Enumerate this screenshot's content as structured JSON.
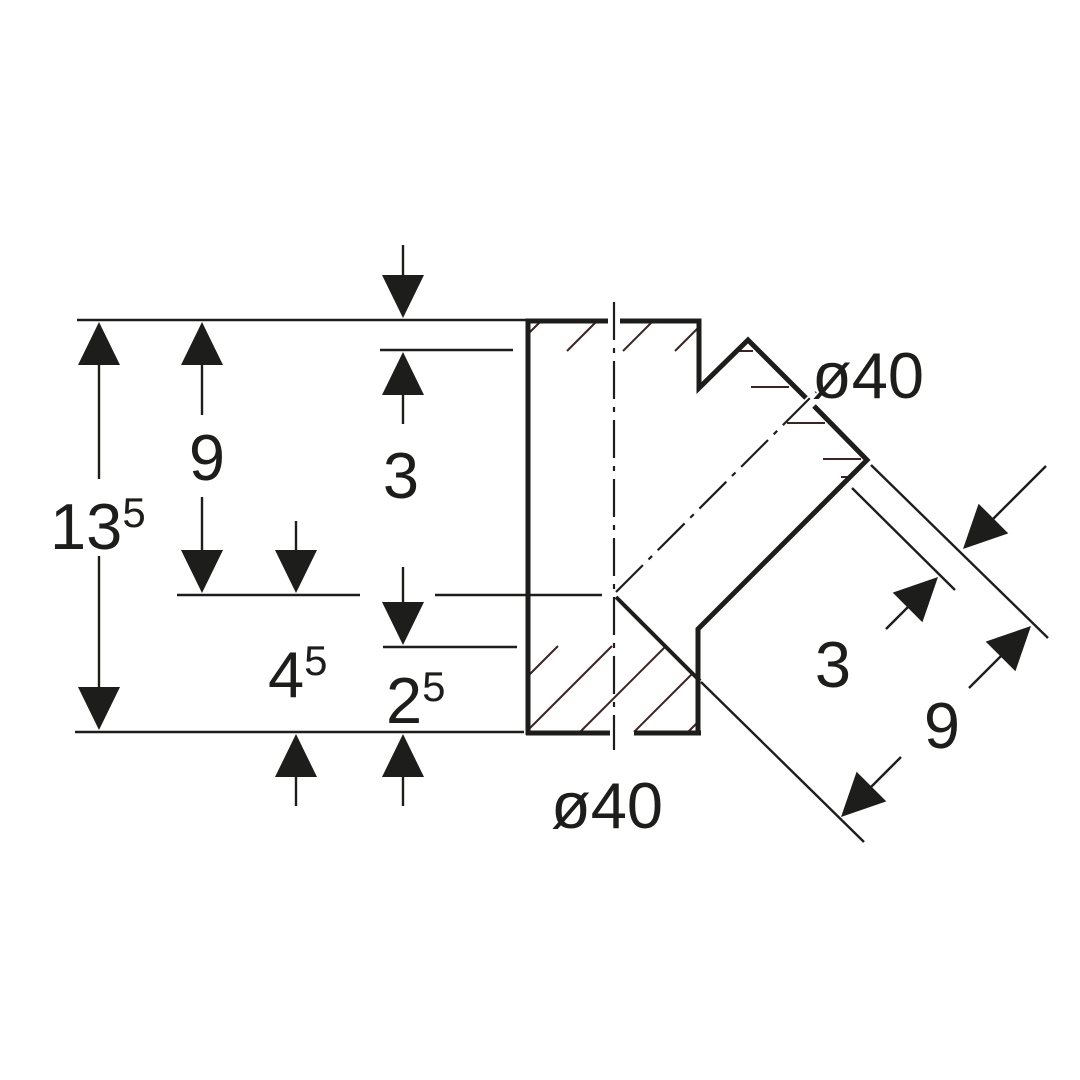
{
  "colors": {
    "ink": "#1d1d1b",
    "hatch": "#3a2424",
    "background": "#ffffff"
  },
  "labels": [
    {
      "name": "dim-label-13-5",
      "x": 50,
      "y": 549,
      "size": 65,
      "anchor": "start",
      "parts": [
        {
          "t": "13"
        },
        {
          "t": "5",
          "sup": true
        }
      ]
    },
    {
      "name": "dim-label-9-left",
      "x": 207,
      "y": 480,
      "size": 65,
      "anchor": "middle",
      "parts": [
        {
          "t": "9"
        }
      ]
    },
    {
      "name": "dim-label-3-top",
      "x": 401,
      "y": 498,
      "size": 65,
      "anchor": "middle",
      "parts": [
        {
          "t": "3"
        }
      ]
    },
    {
      "name": "dim-label-4-5",
      "x": 268,
      "y": 697,
      "size": 65,
      "anchor": "start",
      "parts": [
        {
          "t": "4"
        },
        {
          "t": "5",
          "sup": true
        }
      ]
    },
    {
      "name": "dim-label-2-5",
      "x": 386,
      "y": 723,
      "size": 65,
      "anchor": "start",
      "parts": [
        {
          "t": "2"
        },
        {
          "t": "5",
          "sup": true
        }
      ]
    },
    {
      "name": "label-diameter-40-bottom",
      "x": 551,
      "y": 828,
      "size": 65,
      "anchor": "start",
      "parts": [
        {
          "t": "ø40"
        }
      ]
    },
    {
      "name": "label-diameter-40-branch",
      "x": 812,
      "y": 398,
      "size": 65,
      "anchor": "start",
      "parts": [
        {
          "t": "ø40"
        }
      ]
    },
    {
      "name": "dim-label-3-branch",
      "x": 833,
      "y": 687,
      "size": 65,
      "anchor": "middle",
      "parts": [
        {
          "t": "3"
        }
      ]
    },
    {
      "name": "dim-label-9-branch",
      "x": 942,
      "y": 748,
      "size": 65,
      "anchor": "middle",
      "parts": [
        {
          "t": "9"
        }
      ]
    }
  ],
  "drawing": {
    "outline_polylines": [
      {
        "name": "outline-left-wall-top-edge",
        "w": 5,
        "pts": [
          [
            528,
            735
          ],
          [
            528,
            321
          ],
          [
            608,
            321
          ]
        ]
      },
      {
        "name": "outline-top-edge-notch",
        "w": 5,
        "pts": [
          [
            620,
            321
          ],
          [
            699,
            321
          ],
          [
            699,
            388
          ],
          [
            748,
            340
          ],
          [
            806,
            398
          ]
        ]
      },
      {
        "name": "outline-socket-face-right-wall",
        "w": 5,
        "pts": [
          [
            814,
            406
          ],
          [
            867,
            460
          ],
          [
            698,
            629
          ],
          [
            698,
            735
          ]
        ]
      },
      {
        "name": "outline-bottom-edge-left",
        "w": 5,
        "pts": [
          [
            526,
            733
          ],
          [
            610,
            733
          ]
        ]
      },
      {
        "name": "outline-bottom-edge-right",
        "w": 5,
        "pts": [
          [
            634,
            733
          ],
          [
            701,
            733
          ]
        ]
      }
    ],
    "medium_lines": [
      {
        "name": "junction-section-edge",
        "w": 4,
        "x1": 616,
        "y1": 597,
        "x2": 700,
        "y2": 681
      }
    ],
    "thin_lines": [
      {
        "name": "ref-line-top",
        "x1": 77,
        "y1": 320,
        "x2": 527,
        "y2": 320
      },
      {
        "name": "dim-line-3-top",
        "x1": 380,
        "y1": 350,
        "x2": 513,
        "y2": 350
      },
      {
        "name": "ref-line-mid-left",
        "x1": 177,
        "y1": 595,
        "x2": 360,
        "y2": 595
      },
      {
        "name": "ref-line-mid-right",
        "x1": 435,
        "y1": 595,
        "x2": 602,
        "y2": 595
      },
      {
        "name": "dim-line-2-5",
        "x1": 383,
        "y1": 647,
        "x2": 517,
        "y2": 647
      },
      {
        "name": "ref-line-bottom",
        "x1": 75,
        "y1": 732,
        "x2": 524,
        "y2": 732
      },
      {
        "name": "ext-line-socket-face",
        "x1": 871,
        "y1": 465,
        "x2": 1048,
        "y2": 638
      },
      {
        "name": "ext-line-socket-depth",
        "x1": 852,
        "y1": 488,
        "x2": 955,
        "y2": 590
      },
      {
        "name": "ext-line-junction",
        "x1": 701,
        "y1": 682,
        "x2": 864,
        "y2": 842
      },
      {
        "name": "dim-tail-13-5-upper",
        "x1": 99,
        "y1": 362,
        "x2": 99,
        "y2": 479
      },
      {
        "name": "dim-tail-13-5-lower",
        "x1": 99,
        "y1": 556,
        "x2": 99,
        "y2": 690
      },
      {
        "name": "dim-tail-9-left-upper",
        "x1": 202,
        "y1": 362,
        "x2": 202,
        "y2": 415
      },
      {
        "name": "dim-tail-9-left-lower",
        "x1": 202,
        "y1": 497,
        "x2": 202,
        "y2": 553
      },
      {
        "name": "dim-tail-3-top-upper",
        "x1": 403,
        "y1": 245,
        "x2": 403,
        "y2": 277
      },
      {
        "name": "dim-tail-3-top-lower",
        "x1": 403,
        "y1": 393,
        "x2": 403,
        "y2": 424
      },
      {
        "name": "dim-tail-4-5-upper",
        "x1": 296,
        "y1": 521,
        "x2": 296,
        "y2": 553
      },
      {
        "name": "dim-tail-4-5-lower",
        "x1": 296,
        "y1": 774,
        "x2": 296,
        "y2": 806
      },
      {
        "name": "dim-tail-2-5-upper",
        "x1": 403,
        "y1": 567,
        "x2": 403,
        "y2": 605
      },
      {
        "name": "dim-tail-2-5-lower",
        "x1": 403,
        "y1": 774,
        "x2": 403,
        "y2": 806
      },
      {
        "name": "dim-tail-3-branch-outer",
        "x1": 993,
        "y1": 519,
        "x2": 1046,
        "y2": 466
      },
      {
        "name": "dim-tail-3-branch-inner",
        "x1": 908,
        "y1": 607,
        "x2": 886,
        "y2": 629
      },
      {
        "name": "dim-tail-9-branch-upper",
        "x1": 1001,
        "y1": 656,
        "x2": 969,
        "y2": 688
      },
      {
        "name": "dim-tail-9-branch-lower",
        "x1": 871,
        "y1": 787,
        "x2": 901,
        "y2": 757
      }
    ],
    "centerlines": [
      {
        "name": "centerline-main",
        "x1": 614,
        "y1": 302,
        "x2": 614,
        "y2": 750
      },
      {
        "name": "centerline-branch",
        "x1": 616,
        "y1": 592,
        "x2": 816,
        "y2": 392
      }
    ],
    "arrows": [
      {
        "name": "arrow-13-5-up",
        "tip": [
          99,
          322
        ],
        "angle": -90
      },
      {
        "name": "arrow-13-5-down",
        "tip": [
          99,
          730
        ],
        "angle": 90
      },
      {
        "name": "arrow-9-left-up",
        "tip": [
          202,
          322
        ],
        "angle": -90
      },
      {
        "name": "arrow-9-left-down",
        "tip": [
          202,
          593
        ],
        "angle": 90
      },
      {
        "name": "arrow-3-top-down",
        "tip": [
          403,
          318
        ],
        "angle": 90
      },
      {
        "name": "arrow-3-top-up",
        "tip": [
          403,
          352
        ],
        "angle": -90
      },
      {
        "name": "arrow-4-5-down",
        "tip": [
          296,
          593
        ],
        "angle": 90
      },
      {
        "name": "arrow-4-5-up",
        "tip": [
          296,
          734
        ],
        "angle": -90
      },
      {
        "name": "arrow-2-5-down",
        "tip": [
          403,
          645
        ],
        "angle": 90
      },
      {
        "name": "arrow-2-5-up",
        "tip": [
          403,
          734
        ],
        "angle": -90
      },
      {
        "name": "arrow-3-branch-outer",
        "tip": [
          963,
          549
        ],
        "angle": 135
      },
      {
        "name": "arrow-3-branch-inner",
        "tip": [
          938,
          577
        ],
        "angle": -45
      },
      {
        "name": "arrow-9-branch-upper",
        "tip": [
          1031,
          626
        ],
        "angle": -45
      },
      {
        "name": "arrow-9-branch-lower",
        "tip": [
          841,
          817
        ],
        "angle": 135
      }
    ],
    "hatch_lines": [
      {
        "x1": 530,
        "y1": 332,
        "x2": 541,
        "y2": 321
      },
      {
        "x1": 567,
        "y1": 351,
        "x2": 597,
        "y2": 321
      },
      {
        "x1": 623,
        "y1": 351,
        "x2": 653,
        "y2": 321
      },
      {
        "x1": 675,
        "y1": 351,
        "x2": 700,
        "y2": 326
      },
      {
        "x1": 528,
        "y1": 676,
        "x2": 558,
        "y2": 646
      },
      {
        "x1": 528,
        "y1": 730,
        "x2": 612,
        "y2": 646
      },
      {
        "x1": 580,
        "y1": 732,
        "x2": 666,
        "y2": 646
      },
      {
        "x1": 634,
        "y1": 732,
        "x2": 693,
        "y2": 673
      },
      {
        "x1": 688,
        "y1": 732,
        "x2": 698,
        "y2": 722
      },
      {
        "x1": 737,
        "y1": 351,
        "x2": 753,
        "y2": 351
      },
      {
        "x1": 751,
        "y1": 387,
        "x2": 789,
        "y2": 387
      },
      {
        "x1": 787,
        "y1": 423,
        "x2": 825,
        "y2": 423
      },
      {
        "x1": 823,
        "y1": 459,
        "x2": 861,
        "y2": 459
      },
      {
        "x1": 841,
        "y1": 477,
        "x2": 850,
        "y2": 477
      }
    ],
    "arrow_geometry": {
      "length": 43,
      "half_width": 21
    },
    "centerline_dash": "38 8 5 8"
  }
}
